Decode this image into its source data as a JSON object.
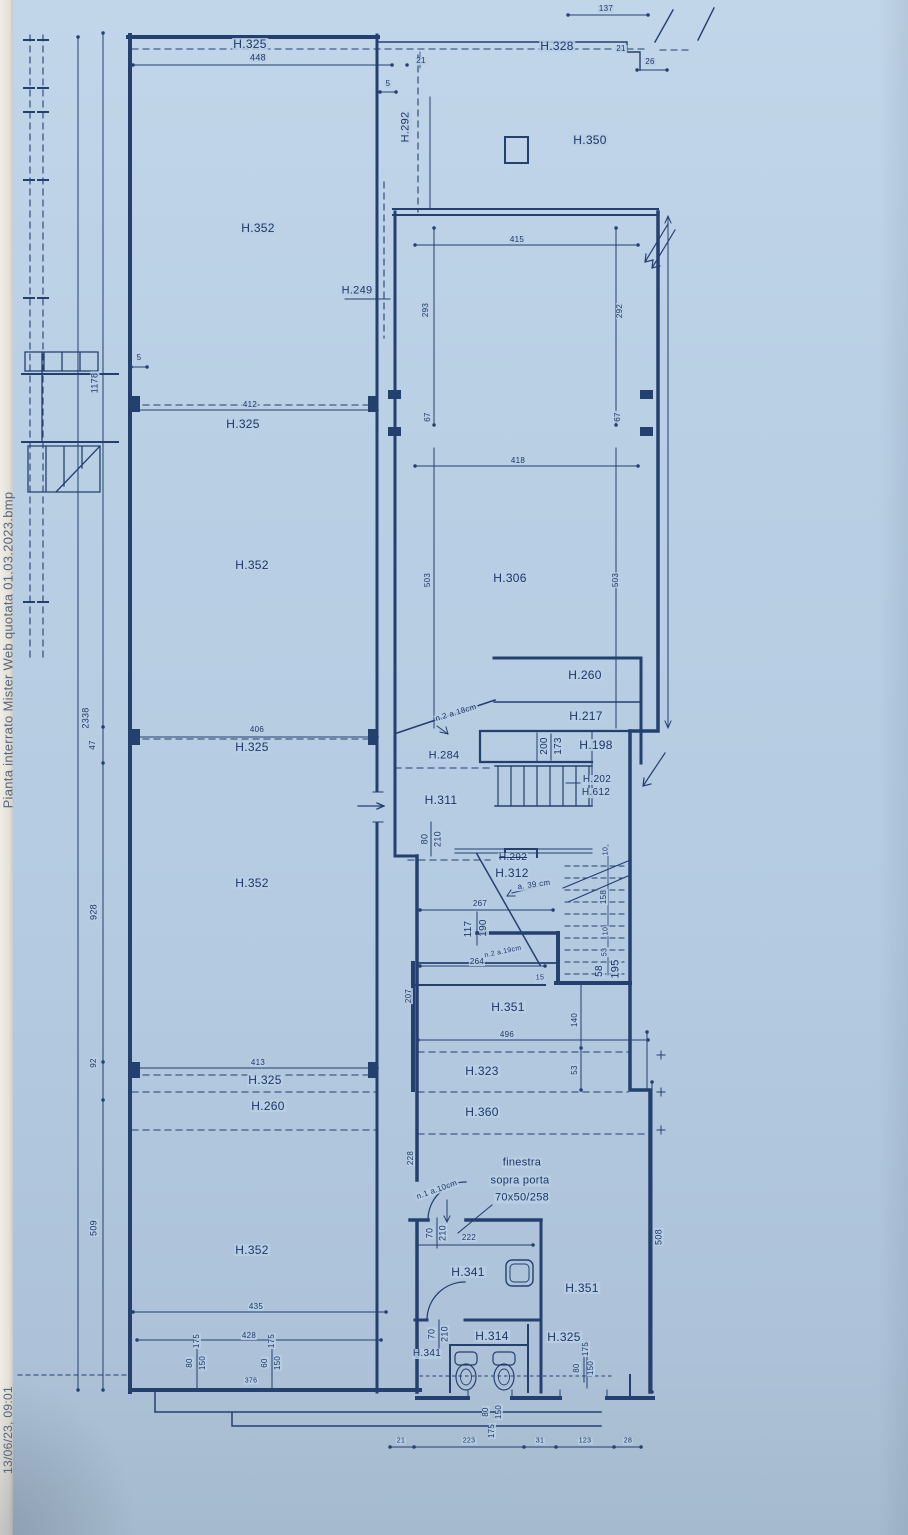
{
  "document": {
    "filename": "Pianta interrato Mister Web quotata 01.03.2023.bmp",
    "timestamp": "13/06/23, 09:01",
    "paper_color": "#b9cfe5",
    "ink_color": "#24406f"
  },
  "plan": {
    "type": "architectural-floor-plan-basement",
    "window_note": [
      "finestra",
      "sopra porta",
      "70x50/258"
    ],
    "labels": [
      {
        "n": "filename",
        "t": "Pianta interrato Mister Web quotata 01.03.2023.bmp",
        "x": 8,
        "y": 650,
        "r": -90,
        "fs": 13,
        "c": "#55657f",
        "nobg": 1
      },
      {
        "n": "timestamp",
        "t": "13/06/23, 09:01",
        "x": 8,
        "y": 1430,
        "r": -90,
        "fs": 12,
        "c": "#55657f",
        "nobg": 1
      },
      {
        "t": "2338",
        "x": 86,
        "y": 718,
        "r": -90,
        "fs": 9
      },
      {
        "t": "1178",
        "x": 95,
        "y": 383,
        "r": -90,
        "fs": 9
      },
      {
        "t": "47",
        "x": 93,
        "y": 745,
        "r": -90,
        "fs": 8
      },
      {
        "t": "928",
        "x": 94,
        "y": 912,
        "r": -90,
        "fs": 9
      },
      {
        "t": "92",
        "x": 94,
        "y": 1063,
        "r": -90,
        "fs": 8
      },
      {
        "t": "509",
        "x": 94,
        "y": 1228,
        "r": -90,
        "fs": 9
      },
      {
        "t": "H.325",
        "x": 250,
        "y": 44,
        "fs": 12
      },
      {
        "t": "448",
        "x": 258,
        "y": 58,
        "fs": 9
      },
      {
        "t": "H.352",
        "x": 258,
        "y": 228,
        "fs": 12
      },
      {
        "t": "5",
        "x": 139,
        "y": 358,
        "fs": 8
      },
      {
        "t": "412",
        "x": 250,
        "y": 405,
        "fs": 8
      },
      {
        "t": "H.325",
        "x": 243,
        "y": 424,
        "fs": 12
      },
      {
        "t": "H.352",
        "x": 252,
        "y": 565,
        "fs": 12
      },
      {
        "t": "406",
        "x": 257,
        "y": 730,
        "fs": 8
      },
      {
        "t": "H.325",
        "x": 252,
        "y": 747,
        "fs": 12
      },
      {
        "t": "H.352",
        "x": 252,
        "y": 883,
        "fs": 12
      },
      {
        "t": "413",
        "x": 258,
        "y": 1063,
        "fs": 8
      },
      {
        "t": "H.325",
        "x": 265,
        "y": 1080,
        "fs": 12
      },
      {
        "t": "H.260",
        "x": 268,
        "y": 1106,
        "fs": 12
      },
      {
        "t": "H.352",
        "x": 252,
        "y": 1250,
        "fs": 12
      },
      {
        "t": "435",
        "x": 256,
        "y": 1307,
        "fs": 8
      },
      {
        "t": "428",
        "x": 249,
        "y": 1336,
        "fs": 8
      },
      {
        "t": "175",
        "x": 197,
        "y": 1341,
        "r": -90,
        "fs": 8
      },
      {
        "t": "80",
        "x": 190,
        "y": 1363,
        "r": -90,
        "fs": 8
      },
      {
        "t": "150",
        "x": 203,
        "y": 1363,
        "r": -90,
        "fs": 8
      },
      {
        "t": "175",
        "x": 272,
        "y": 1341,
        "r": -90,
        "fs": 8
      },
      {
        "t": "60",
        "x": 265,
        "y": 1363,
        "r": -90,
        "fs": 8
      },
      {
        "t": "150",
        "x": 278,
        "y": 1363,
        "r": -90,
        "fs": 8
      },
      {
        "t": "376",
        "x": 251,
        "y": 1381,
        "fs": 7
      },
      {
        "t": "137",
        "x": 606,
        "y": 9,
        "fs": 8
      },
      {
        "t": "H.328",
        "x": 557,
        "y": 46,
        "fs": 12
      },
      {
        "t": "21",
        "x": 421,
        "y": 61,
        "fs": 8
      },
      {
        "t": "21",
        "x": 621,
        "y": 49,
        "fs": 8
      },
      {
        "t": "26",
        "x": 650,
        "y": 62,
        "fs": 8
      },
      {
        "t": "5",
        "x": 388,
        "y": 84,
        "fs": 8
      },
      {
        "t": "H.292",
        "x": 406,
        "y": 127,
        "r": -90,
        "fs": 11
      },
      {
        "t": "H.350",
        "x": 590,
        "y": 140,
        "fs": 12
      },
      {
        "t": "415",
        "x": 517,
        "y": 240,
        "fs": 8
      },
      {
        "t": "293",
        "x": 426,
        "y": 310,
        "r": -90,
        "fs": 8
      },
      {
        "t": "292",
        "x": 620,
        "y": 311,
        "r": -90,
        "fs": 8
      },
      {
        "t": "67",
        "x": 428,
        "y": 417,
        "r": -90,
        "fs": 8
      },
      {
        "t": "67",
        "x": 618,
        "y": 417,
        "r": -90,
        "fs": 8
      },
      {
        "t": "H.249",
        "x": 357,
        "y": 291,
        "fs": 11
      },
      {
        "t": "418",
        "x": 518,
        "y": 461,
        "fs": 8
      },
      {
        "t": "503",
        "x": 428,
        "y": 580,
        "r": -90,
        "fs": 8
      },
      {
        "t": "503",
        "x": 616,
        "y": 580,
        "r": -90,
        "fs": 8
      },
      {
        "t": "H.306",
        "x": 510,
        "y": 578,
        "fs": 12
      },
      {
        "t": "H.260",
        "x": 585,
        "y": 675,
        "fs": 12
      },
      {
        "t": "H.217",
        "x": 586,
        "y": 716,
        "fs": 12
      },
      {
        "t": "200",
        "x": 545,
        "y": 746,
        "r": -90,
        "fs": 10
      },
      {
        "t": "173",
        "x": 559,
        "y": 746,
        "r": -90,
        "fs": 10
      },
      {
        "t": "H.198",
        "x": 596,
        "y": 745,
        "fs": 12
      },
      {
        "t": "n.2 a.18cm",
        "x": 456,
        "y": 713,
        "r": -17,
        "fs": 8
      },
      {
        "t": "H.284",
        "x": 444,
        "y": 756,
        "fs": 11
      },
      {
        "t": "H.202",
        "x": 597,
        "y": 780,
        "fs": 10
      },
      {
        "t": "H.612",
        "x": 596,
        "y": 793,
        "fs": 10
      },
      {
        "t": "H.311",
        "x": 441,
        "y": 800,
        "fs": 12
      },
      {
        "t": "80",
        "x": 425,
        "y": 839,
        "r": -90,
        "fs": 9
      },
      {
        "t": "210",
        "x": 438,
        "y": 839,
        "r": -90,
        "fs": 9
      },
      {
        "t": "H.292",
        "x": 513,
        "y": 858,
        "fs": 10,
        "strike": 1
      },
      {
        "t": "H.312",
        "x": 512,
        "y": 873,
        "fs": 12
      },
      {
        "t": "a. 39 cm",
        "x": 534,
        "y": 885,
        "r": -8,
        "fs": 8
      },
      {
        "t": "267",
        "x": 480,
        "y": 904,
        "fs": 8
      },
      {
        "t": "117",
        "x": 469,
        "y": 929,
        "r": -90,
        "fs": 10
      },
      {
        "t": "190",
        "x": 484,
        "y": 928,
        "r": -90,
        "fs": 10
      },
      {
        "t": "n.2 a.19cm",
        "x": 503,
        "y": 952,
        "r": -12,
        "fs": 7
      },
      {
        "t": "264",
        "x": 477,
        "y": 962,
        "fs": 8
      },
      {
        "t": "10",
        "x": 606,
        "y": 851,
        "r": -90,
        "fs": 7
      },
      {
        "t": "158",
        "x": 604,
        "y": 897,
        "r": -90,
        "fs": 8
      },
      {
        "t": "10",
        "x": 606,
        "y": 931,
        "r": -90,
        "fs": 7
      },
      {
        "t": "53",
        "x": 605,
        "y": 952,
        "r": -90,
        "fs": 7
      },
      {
        "t": "58",
        "x": 600,
        "y": 971,
        "r": -90,
        "fs": 10
      },
      {
        "t": "195",
        "x": 616,
        "y": 969,
        "r": -90,
        "fs": 11
      },
      {
        "t": "15",
        "x": 540,
        "y": 978,
        "fs": 7
      },
      {
        "t": "207",
        "x": 409,
        "y": 996,
        "r": -90,
        "fs": 8
      },
      {
        "t": "H.351",
        "x": 508,
        "y": 1007,
        "fs": 12
      },
      {
        "t": "496",
        "x": 507,
        "y": 1035,
        "fs": 8
      },
      {
        "t": "140",
        "x": 575,
        "y": 1020,
        "r": -90,
        "fs": 8
      },
      {
        "t": "53",
        "x": 575,
        "y": 1070,
        "r": -90,
        "fs": 8
      },
      {
        "t": "H.323",
        "x": 482,
        "y": 1071,
        "fs": 12
      },
      {
        "t": "H.360",
        "x": 482,
        "y": 1112,
        "fs": 12
      },
      {
        "t": "508",
        "x": 659,
        "y": 1237,
        "r": -90,
        "fs": 9
      },
      {
        "t": "228",
        "x": 411,
        "y": 1158,
        "r": -90,
        "fs": 8
      },
      {
        "n": "finestra-note-1",
        "t": "finestra",
        "x": 522,
        "y": 1163,
        "fs": 11
      },
      {
        "n": "finestra-note-2",
        "t": "sopra porta",
        "x": 520,
        "y": 1181,
        "fs": 11
      },
      {
        "n": "finestra-note-3",
        "t": "70x50/258",
        "x": 522,
        "y": 1198,
        "fs": 11
      },
      {
        "t": "n.1 a.10cm",
        "x": 437,
        "y": 1190,
        "r": -20,
        "fs": 8
      },
      {
        "t": "70",
        "x": 430,
        "y": 1233,
        "r": -90,
        "fs": 9
      },
      {
        "t": "210",
        "x": 443,
        "y": 1233,
        "r": -90,
        "fs": 9
      },
      {
        "t": "222",
        "x": 469,
        "y": 1238,
        "fs": 8
      },
      {
        "t": "H.341",
        "x": 468,
        "y": 1272,
        "fs": 12
      },
      {
        "t": "H.351",
        "x": 582,
        "y": 1288,
        "fs": 12
      },
      {
        "t": "70",
        "x": 432,
        "y": 1334,
        "r": -90,
        "fs": 9
      },
      {
        "t": "210",
        "x": 445,
        "y": 1334,
        "r": -90,
        "fs": 9
      },
      {
        "t": "H.314",
        "x": 492,
        "y": 1336,
        "fs": 12
      },
      {
        "t": "H.341",
        "x": 427,
        "y": 1354,
        "fs": 10
      },
      {
        "t": "H.325",
        "x": 564,
        "y": 1337,
        "fs": 12
      },
      {
        "t": "175",
        "x": 586,
        "y": 1349,
        "r": -90,
        "fs": 8
      },
      {
        "t": "80",
        "x": 577,
        "y": 1368,
        "r": -90,
        "fs": 8
      },
      {
        "t": "150",
        "x": 591,
        "y": 1368,
        "r": -90,
        "fs": 8
      },
      {
        "t": "80",
        "x": 486,
        "y": 1412,
        "r": -90,
        "fs": 8
      },
      {
        "t": "150",
        "x": 499,
        "y": 1412,
        "r": -90,
        "fs": 8
      },
      {
        "t": "175",
        "x": 492,
        "y": 1431,
        "r": -90,
        "fs": 8
      },
      {
        "t": "21",
        "x": 401,
        "y": 1441,
        "fs": 7
      },
      {
        "t": "223",
        "x": 469,
        "y": 1441,
        "fs": 7
      },
      {
        "t": "31",
        "x": 540,
        "y": 1441,
        "fs": 7
      },
      {
        "t": "123",
        "x": 585,
        "y": 1441,
        "fs": 7
      },
      {
        "t": "28",
        "x": 628,
        "y": 1441,
        "fs": 7
      }
    ]
  }
}
